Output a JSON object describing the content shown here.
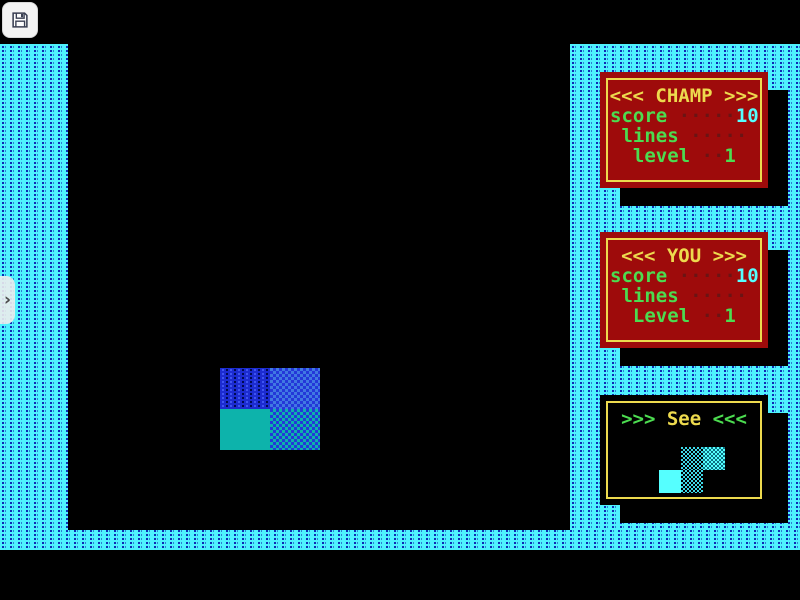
{
  "toolbar": {
    "save_icon": "floppy-disk"
  },
  "drawer": {
    "icon": "chevron-right",
    "glyph": "›"
  },
  "panels": {
    "champ": {
      "title": "<<< CHAMP >>>",
      "rows": [
        {
          "label": "score",
          "dots": " ·····",
          "value": "10"
        },
        {
          "label": " lines",
          "dots": " ·····",
          "value": ""
        },
        {
          "label": "  level",
          "dots": " ··",
          "value": "1"
        }
      ]
    },
    "you": {
      "title": "<<< YOU >>>",
      "rows": [
        {
          "label": "score",
          "dots": " ·····",
          "value": "10"
        },
        {
          "label": " lines",
          "dots": " ·····",
          "value": ""
        },
        {
          "label": "  Level",
          "dots": " ··",
          "value": "1"
        }
      ]
    },
    "see": {
      "title_prefix": ">>> ",
      "title_word": "See",
      "title_suffix": " <<<"
    }
  },
  "game": {
    "falling_piece": {
      "type": "O-piece",
      "styles": [
        "blue-dashed",
        "blue-checker",
        "teal-solid",
        "teal-blue-checker"
      ]
    },
    "next_piece": {
      "type": "S-piece",
      "styles": [
        "cyan-dither-dark",
        "cyan-dither-bright",
        "cyan-solid",
        "cyan-dither-dark"
      ]
    }
  },
  "colors": {
    "border_cyan": "#4FF2FE",
    "border_dash_blue": "#0F2CB4",
    "panel_red": "#9E0B0B",
    "panel_yellow": "#EDDA4E",
    "label_green": "#4CDC50",
    "value_cyan": "#55FFFF",
    "dots_dark_red": "#6B1414",
    "block_blue": "#1C2CD0",
    "block_teal": "#0DB3AB"
  }
}
